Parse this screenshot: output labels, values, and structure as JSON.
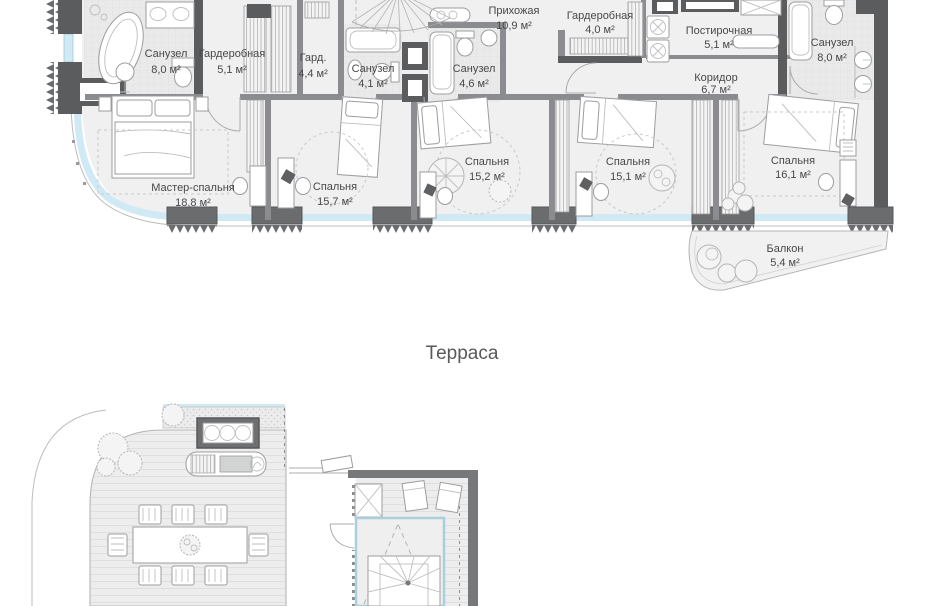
{
  "meta": {
    "kind": "residential floor plan",
    "language": "ru"
  },
  "palette": {
    "wall_dark": "#5b5c5e",
    "wall_partition": "#8a8c8f",
    "pier": "#6b6c6e",
    "glazing_blue": "#cfe9f5",
    "slab": "#f0f0f1",
    "tile": "#eaeaeb",
    "deck": "#ededed",
    "label_text": "#47484a",
    "heading_text": "#58595b"
  },
  "rooms": [
    {
      "name": "Санузел",
      "area": "8,0 м²"
    },
    {
      "name": "Гардеробная",
      "area": "5,1 м²"
    },
    {
      "name": "Гард.",
      "area": "4,4 м²"
    },
    {
      "name": "Санузел",
      "area": "4,1 м²"
    },
    {
      "name": "Санузел",
      "area": "4,6 м²"
    },
    {
      "name": "Прихожая",
      "area": "10,9 м²"
    },
    {
      "name": "Гардеробная",
      "area": "4,0 м²"
    },
    {
      "name": "Постирочная",
      "area": "5,1 м²"
    },
    {
      "name": "Коридор",
      "area": "6,7 м²"
    },
    {
      "name": "Санузел",
      "area": "8,0 м²"
    },
    {
      "name": "Мастер-спальня",
      "area": "18,8 м²"
    },
    {
      "name": "Спальня",
      "area": "15,7 м²"
    },
    {
      "name": "Спальня",
      "area": "15,2 м²"
    },
    {
      "name": "Спальня",
      "area": "15,1 м²"
    },
    {
      "name": "Спальня",
      "area": "16,1 м²"
    },
    {
      "name": "Балкон",
      "area": "5,4 м²"
    }
  ],
  "terrace": {
    "label": "Терраса"
  }
}
